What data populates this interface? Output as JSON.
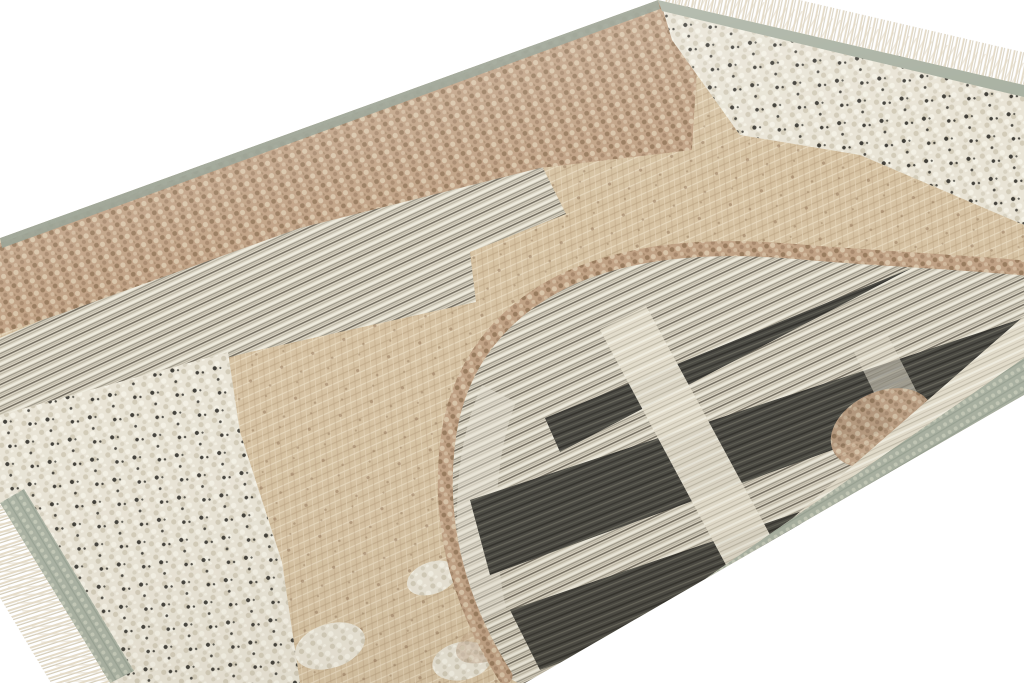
{
  "scene": {
    "description": "Angled product photograph of a modern flatweave kilim rug with an arch motif, lying on a plain white studio background",
    "background_color": "#ffffff"
  },
  "rug": {
    "parts": {
      "field": "beige-tan plain weave field",
      "border_brown": "brown boucle border band along upper-left long edge",
      "border_white": "white speckled boucle band along upper-right fringed end",
      "stripe_block": "grey-white striped block, upper left",
      "white_block": "white boucle block with black speckles, lower left corner",
      "arch": "large arch motif outlined in tan boucle, filled with grey stripes and charcoal bands",
      "charcoal_bands": "charcoal striped bands inside arch",
      "cross_stripe": "light stripe crossing the charcoal bands",
      "selvedge": "sage grey-green selvedge edges",
      "fringe": "cream fringe tassels on both short ends"
    },
    "palette": {
      "background": "#ffffff",
      "tan_base": "#d6c2a2",
      "tan_light": "#e8dabf",
      "tan_dark": "#b49a77",
      "brown_base": "#c0a184",
      "brown_dark": "#8d7053",
      "brown_light": "#dcc9ad",
      "white_base": "#e9e4d6",
      "white_shade": "#d2cbb8",
      "white_light": "#f4f1e5",
      "speck_black": "#24231e",
      "grey_stripe_base": "#dcd6c6",
      "grey_stripe_mid": "#9b9481",
      "grey_stripe_dark": "#6a6458",
      "stripe_light_base": "#e4decd",
      "charcoal_base": "#474640",
      "charcoal_dark": "#2f2e29",
      "charcoal_light": "#706f62",
      "selvedge": "#a9b1a2",
      "selvedge_light": "#c6cbba",
      "selvedge_dark": "#929c8e",
      "fringe": "#e4dbc8",
      "fringe_shade": "#cdc3ac",
      "shade_warm": "#6b5f4a"
    }
  }
}
